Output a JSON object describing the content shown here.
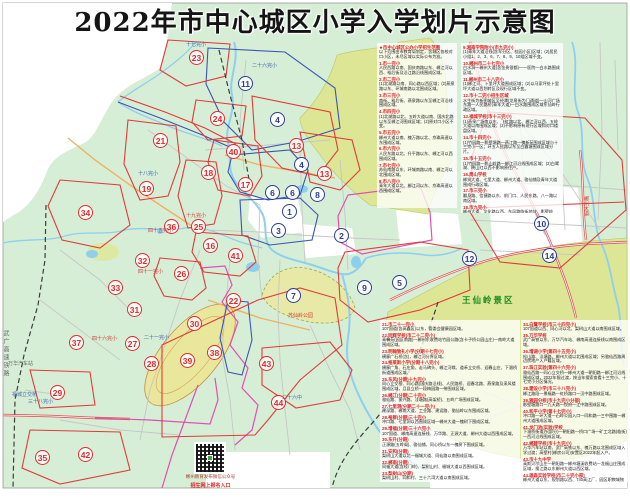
{
  "title": "2022年市中心城区小学入学划片示意图",
  "colors": {
    "land": "#d7eed6",
    "scenic": "#dce694",
    "park": "#e8e9a6",
    "water": "#8ecfee",
    "highway": "#dd5b5b",
    "boundary_red": "#e23a3a",
    "boundary_blue": "#3a55b4",
    "boundary_magenta": "#e050b0",
    "marker_red": "#e02a2a",
    "marker_navy": "#2b3c96"
  },
  "map": {
    "scenic_label": "王仙岭景区",
    "railway_label": "武广高速铁路",
    "markers": [
      {
        "n": "1",
        "x": 290,
        "y": 212,
        "c": "navy"
      },
      {
        "n": "2",
        "x": 342,
        "y": 236,
        "c": "navy"
      },
      {
        "n": "3",
        "x": 279,
        "y": 231,
        "c": "navy"
      },
      {
        "n": "4",
        "x": 278,
        "y": 120,
        "c": "navy"
      },
      {
        "n": "4",
        "x": 302,
        "y": 165,
        "c": "navy"
      },
      {
        "n": "5",
        "x": 400,
        "y": 283,
        "c": "navy"
      },
      {
        "n": "6",
        "x": 273,
        "y": 193,
        "c": "navy"
      },
      {
        "n": "6",
        "x": 293,
        "y": 193,
        "c": "navy"
      },
      {
        "n": "7",
        "x": 294,
        "y": 296,
        "c": "navy"
      },
      {
        "n": "8",
        "x": 318,
        "y": 195,
        "c": "navy"
      },
      {
        "n": "9",
        "x": 365,
        "y": 288,
        "c": "navy"
      },
      {
        "n": "10",
        "x": 542,
        "y": 224,
        "c": "navy"
      },
      {
        "n": "11",
        "x": 246,
        "y": 84,
        "c": "navy"
      },
      {
        "n": "12",
        "x": 470,
        "y": 259,
        "c": "navy"
      },
      {
        "n": "14",
        "x": 550,
        "y": 256,
        "c": "navy"
      },
      {
        "n": "13",
        "x": 297,
        "y": 146,
        "c": "red"
      },
      {
        "n": "13",
        "x": 325,
        "y": 174,
        "c": "red"
      },
      {
        "n": "16",
        "x": 211,
        "y": 246,
        "c": "red"
      },
      {
        "n": "17",
        "x": 246,
        "y": 185,
        "c": "red"
      },
      {
        "n": "18",
        "x": 209,
        "y": 173,
        "c": "red"
      },
      {
        "n": "19",
        "x": 147,
        "y": 189,
        "c": "red"
      },
      {
        "n": "21",
        "x": 161,
        "y": 141,
        "c": "red"
      },
      {
        "n": "22",
        "x": 234,
        "y": 301,
        "c": "red"
      },
      {
        "n": "23",
        "x": 197,
        "y": 58,
        "c": "red"
      },
      {
        "n": "24",
        "x": 218,
        "y": 119,
        "c": "red"
      },
      {
        "n": "25",
        "x": 199,
        "y": 227,
        "c": "red"
      },
      {
        "n": "26",
        "x": 182,
        "y": 274,
        "c": "red"
      },
      {
        "n": "27",
        "x": 133,
        "y": 344,
        "c": "red"
      },
      {
        "n": "28",
        "x": 152,
        "y": 364,
        "c": "red"
      },
      {
        "n": "29",
        "x": 58,
        "y": 393,
        "c": "red"
      },
      {
        "n": "30",
        "x": 195,
        "y": 324,
        "c": "red"
      },
      {
        "n": "31",
        "x": 135,
        "y": 310,
        "c": "red"
      },
      {
        "n": "32",
        "x": 143,
        "y": 261,
        "c": "red"
      },
      {
        "n": "33",
        "x": 116,
        "y": 288,
        "c": "red"
      },
      {
        "n": "34",
        "x": 86,
        "y": 213,
        "c": "red"
      },
      {
        "n": "35",
        "x": 43,
        "y": 458,
        "c": "red"
      },
      {
        "n": "36",
        "x": 172,
        "y": 227,
        "c": "red"
      },
      {
        "n": "37",
        "x": 77,
        "y": 343,
        "c": "red"
      },
      {
        "n": "38",
        "x": 215,
        "y": 353,
        "c": "red"
      },
      {
        "n": "39",
        "x": 188,
        "y": 361,
        "c": "red"
      },
      {
        "n": "40",
        "x": 234,
        "y": 152,
        "c": "red"
      },
      {
        "n": "41",
        "x": 236,
        "y": 256,
        "c": "red"
      },
      {
        "n": "42",
        "x": 86,
        "y": 455,
        "c": "red"
      },
      {
        "n": "43",
        "x": 267,
        "y": 364,
        "c": "red"
      },
      {
        "n": "44",
        "x": 279,
        "y": 403,
        "c": "red"
      }
    ],
    "labels": [
      {
        "t": "十七完小",
        "x": 186,
        "y": 43,
        "c": "b"
      },
      {
        "t": "二十六完小",
        "x": 252,
        "y": 64,
        "c": "b"
      },
      {
        "t": "十八完小",
        "x": 138,
        "y": 172,
        "c": "b"
      },
      {
        "t": "三十八完小",
        "x": 28,
        "y": 400,
        "c": "b"
      },
      {
        "t": "四十五完小",
        "x": 148,
        "y": 229,
        "c": "r"
      },
      {
        "t": "十九完小",
        "x": 186,
        "y": 214,
        "c": "r"
      },
      {
        "t": "四十六完小",
        "x": 92,
        "y": 337,
        "c": "r"
      },
      {
        "t": "二十一完小",
        "x": 144,
        "y": 336,
        "c": "b"
      },
      {
        "t": "四十一完小",
        "x": 138,
        "y": 270,
        "c": "r"
      },
      {
        "t": "万华汽车站",
        "x": 8,
        "y": 362,
        "c": "g"
      },
      {
        "t": "福城立交桥",
        "x": 12,
        "y": 393,
        "c": "b"
      },
      {
        "t": "苏仙岭公园",
        "x": 288,
        "y": 314,
        "c": "r"
      },
      {
        "t": "二十六中",
        "x": 282,
        "y": 396,
        "c": "b"
      },
      {
        "t": "郴州大道",
        "x": 583,
        "y": 196,
        "c": "r",
        "v": true
      }
    ]
  },
  "qr": {
    "caption1": "郴州教育发布微信公众号",
    "caption2": "招生网上报名入口"
  },
  "panels": {
    "top_left": [
      {
        "h": "★市中心城区公办小学招生范围",
        "b": "以下范围由市教育局划定，含城区各校对口小区，未尽区域以实际公布为准。"
      },
      {
        "h": "1.市一完小",
        "b": "人民西路以南、国庆南路以东、郴江河以西、裕后街及沿江路沿线围成区域。"
      },
      {
        "h": "2.市二完小",
        "b": "(1)北湖路以南、同心路以西区域；(2)燕泉路以东、环城南路以北围成区域。"
      },
      {
        "h": "3.市三完小",
        "b": "南街、裕后街、燕泉路以东至郴江河沿线围成区域。"
      },
      {
        "h": "4.市四完小",
        "b": "(1)北湖路以北、五岭大道以南、国庆北路以东至郴江河围成区域；(2)原对口小区不变。"
      },
      {
        "h": "5.市五完小",
        "b": "郴州大道以南、槐万路以北、京珠高速以东围成区域。"
      },
      {
        "h": "6.市六完小",
        "b": "人民东路以北、升平路以东、郴江河以西围成区域。"
      },
      {
        "h": "7.市七完小",
        "b": "苏仙南路以东、环城南路以南、郴江河以北围成区域。"
      },
      {
        "h": "8.市八完小",
        "b": "青年大道以北、郴江河以东、京珠高速以西围成区域。"
      }
    ],
    "top_right": [
      {
        "h": "9.湘南学院附小(市九完小)",
        "b": "(1)青年大道沿线(含军分区、桂园小区)区域；(2)居民小组1、2、3、6、7、8、9、10组区域不变。"
      },
      {
        "h": "10.郴州市二十七完小",
        "b": "白水洞—郴州大道(含金贵银都)—一医院—白水路围成区域。"
      },
      {
        "h": "11.郴州市二十八完小",
        "b": "(1)郴江河、卜里坪大道围成区域；(2)以马家坪处卜里坪大道以西划转区及现行区域不变。"
      },
      {
        "h": "12.市十二完小招生区域",
        "b": "水生街为新图城区至经潭(龙泉街为门通道)—山河广场东路—人民路桥(青年大道)—白水路围成区域东仙岭行政区域。"
      },
      {
        "h": "13.福城学校(市十三完小)",
        "b": "(1)燕泉广场南以东、飞虹路以北、郴江河以西、五岭大道以南围成区域；(2)不影响原有现行区域和对口楼盘区域。"
      },
      {
        "h": "14.市十四完小",
        "b": "(1)竹园路—影壁塘路—燕江路—槐新苑围成区域与十三完小一区；环五人民路以东至白露塘围成区域分片。"
      },
      {
        "h": "15.市十五完小",
        "b": "(1)竹园路—影山岭路—郴江河沿线围成区域；(2)白鹭湖、映山红以西不影响原住户。"
      },
      {
        "h": "16.周山学校",
        "b": "郴贤大道、七里大道、郴州大道、骆仙铺及青年大道围成行政区域。"
      },
      {
        "h": "17.市三完小",
        "b": "翻身路、信捷路以东、前门口、人民东路、八一路以南区域。"
      },
      {
        "h": "18.市九完小",
        "b": "郴州大道、文化路以西、东风路临街地块、影壁岭路、人民西路围成区域。"
      },
      {
        "h": "19.市十完小",
        "b": "罗家井、健康路以东至城前岭、骆仙岭、燕泉路口围成区域。"
      },
      {
        "h": "20.市十九完小",
        "b": "郴州大道以西、同心路—郴州大道围成区域。"
      }
    ],
    "bottom_left": [
      {
        "h": "21.市二十一完小",
        "b": "107国道(含高鑫区)以东，管委会健康园区域。"
      },
      {
        "h": "22.同辉学校(市二十二完小)",
        "b": "青馨苑(园区南路)—郴州东收费站竹园公路(含卡子桥公园山庄)—南岭大道围成区域。"
      },
      {
        "h": "23.明翰致礼小学(分期十七完小)",
        "b": "横廊广石桥(含)，郴江河分界区域。"
      },
      {
        "h": "24.格莱斯小学(分期十八完小)",
        "b": "横廊广角、石庄角、走马碑头、郴江河缘、道禾立交桥、迎春山庄、下湄桥街道围成区域。"
      },
      {
        "h": "25.东风(分期)十九完小",
        "b": "同心立交桥、同心路(国庆路沿线)、人民路桥、迎春北路、燕泉路及采风楼围成区域，且县立桥一段梅园路一带围成区域。"
      },
      {
        "h": "26.郴江(分期)二十完小",
        "b": "骆仙路、振兴路、洼塘路(高架桥)、五岭广场围成区域。"
      },
      {
        "h": "27.七里洞(分期二十一完小)",
        "b": "建深路、郴南大道、工业路、建设路、骆仙岭以东围成区域。"
      },
      {
        "h": "28.裕群(分期)三十完小",
        "b": "冲口路、七里洞以西围成区域—郴州大道—槐树下围成区域。"
      },
      {
        "h": "29.增福(分期)三十六完小",
        "b": "107国道、郴南高速连接线、万华路、正源大道、郴州大道以西围成区域。"
      },
      {
        "h": "30.东升(分期)",
        "b": "正源路(五岭阁)、骆仙铺、同心桥以东—槐树下围成区域。"
      },
      {
        "h": "31.安和(分期)",
        "b": "梨树山大道以北—福城大道、同仙路以南围成区域。"
      },
      {
        "h": "32.郴南(分期)",
        "b": "同福大道(含桂门岭)、梨树山村、福城大道以西围成区域。"
      },
      {
        "h": "33.梨树山(分期)",
        "b": "梨树山村、同和村、三十六湾大道以南围成区域。"
      }
    ],
    "bottom_right": [
      {
        "h": "34.白鹭学校(市三十四完小)",
        "b": "107国道以西、同心河以北、梨树山大道以南围成区域。"
      },
      {
        "h": "35.万华学校",
        "b": "武广高铁以东、万华汽车站、郴南高速连接线以南围成区域。"
      },
      {
        "h": "36.增湖小学(第四十五完小)",
        "b": "松山路、洼塘路、郴州大道以北围成区域；另骆仙西路周边房地产入户籍区域。"
      },
      {
        "h": "37.珠江实验(第四十六完小)",
        "b": "骆仙西路—同心立交桥—郴州大道—朝阳路—郴江河沿线围成区域，2022年限过渡，按当年搜索查看十三完小、十七完小分区情况。"
      },
      {
        "h": "38.建设小学(市三十八完小)",
        "b": "郴江路段—景福路—虹桥路口—汉中路围成区域。"
      },
      {
        "h": "39.雅园分校(市十九完小分部)",
        "b": "影壁塘路口—九天路—悦府—江中路围成区域。"
      },
      {
        "h": "40.和平小学(第十七完小)",
        "b": "冲口路—环大道—石岭公园入口—同和路—三中围路—郴州大道围成区域。"
      },
      {
        "h": "41.龙门池(实验)学校",
        "b": "下湄桥街道办(部分)—朝阳路—桥口广场—矿工北路(临街)—西河沿线围成区域。"
      },
      {
        "h": "42.郴建学校(市十九完小)",
        "b": "万华汽车站以南、武广高铁以东、槐万路以北围成区域入学过渡；高壁村(郴房公司)安置区2022年起入户。"
      },
      {
        "h": "43.市十九中学",
        "b": "高斯贝尔山庄—朝阳路—郴州塘溪收费站—龙福山庄围成区域，搜江路以东郴州大道以西区域。"
      },
      {
        "h": "44.雄森实验学校(市二十完小部)",
        "b": "郴州大道以东、规划路以西、740高江厂、园区职教城物流园围成区域。"
      }
    ]
  }
}
